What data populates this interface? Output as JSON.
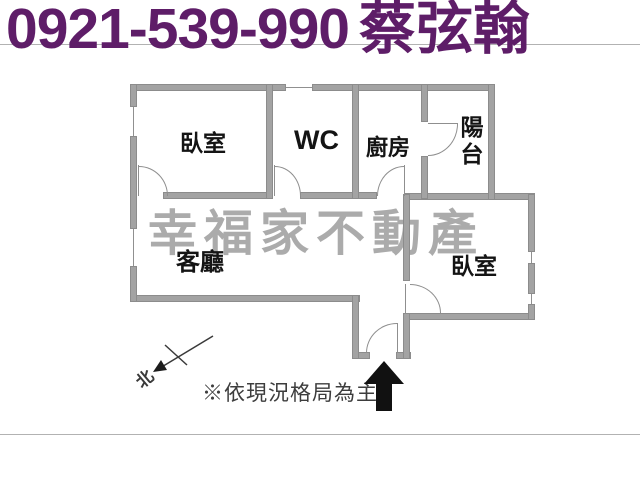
{
  "header": {
    "phone": "0921-539-990",
    "agent": "蔡弦翰"
  },
  "watermark": "幸福家不動產",
  "rooms": {
    "bedroom_left": "臥室",
    "wc": "WC",
    "kitchen": "廚房",
    "balcony": "陽台",
    "living": "客廳",
    "bedroom_right": "臥室"
  },
  "compass": {
    "north_label": "北"
  },
  "note": "※依現況格局為主",
  "colors": {
    "header_text": "#5e1d68",
    "wall": "#a3a3a3",
    "watermark": "#ababab",
    "note_text": "#3d3d3d",
    "entrance_arrow": "#111111"
  }
}
